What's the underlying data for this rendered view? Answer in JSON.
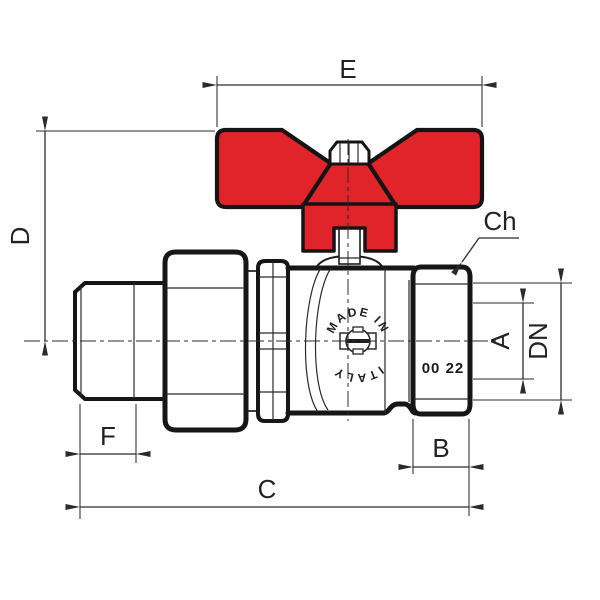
{
  "drawing": {
    "type": "technical-dimension-drawing",
    "subject": "ball valve with butterfly handle and union tailpiece",
    "colors": {
      "handle": "#e0242a",
      "outline": "#161616",
      "dimension": "#2b2b2b",
      "background": "#ffffff"
    },
    "labels": {
      "e": "E",
      "d": "D",
      "ch": "Ch",
      "a": "A",
      "dn": "DN",
      "f": "F",
      "b": "B",
      "c": "C"
    },
    "markings": {
      "arc_top": "MADE IN",
      "arc_bottom": "ITALY",
      "stamp": "00 22"
    }
  }
}
